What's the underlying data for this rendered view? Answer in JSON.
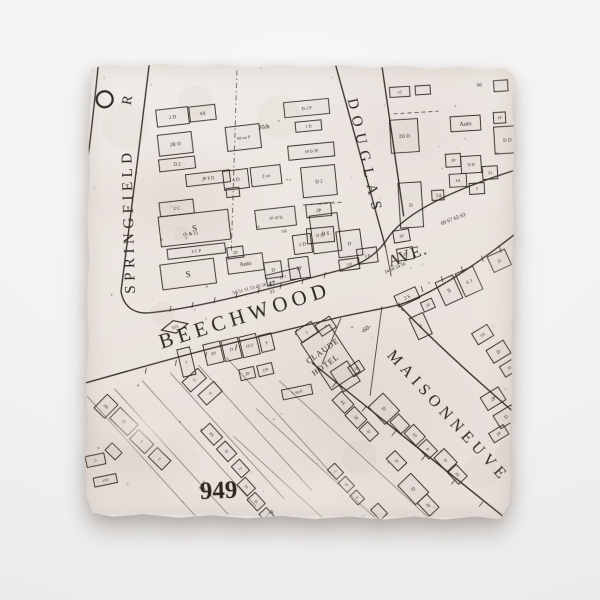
{
  "colors": {
    "ink": "#2e2722",
    "tile": "#ebe4df",
    "background": "#f3f2f1"
  },
  "map": {
    "roads": [
      {
        "id": "springfield-west",
        "d": "M 12,-4 C 6,66 -4,150 -16,234"
      },
      {
        "id": "springfield-east-beechwood-north",
        "d": "M 63,-4 C 55,70 44,162 36,230 C 39,246 50,253 66,251 C 112,246 178,228 254,207 C 281,200 294,188 304,172 C 321,149 364,126 433,104"
      },
      {
        "id": "beechwood-south",
        "d": "M -6,324 C 42,310 95,294 154,279 C 205,266 230,260 254,254 C 280,248 298,245 314,241 C 354,228 404,190 436,164"
      },
      {
        "id": "maisonneuve-north",
        "d": "M 314,241 C 336,264 374,300 433,350"
      },
      {
        "id": "maisonneuve-south",
        "d": "M 228,300 C 278,340 360,404 432,461"
      },
      {
        "id": "douglas-west",
        "d": "M 247,-4 L 300,183"
      },
      {
        "id": "douglas-east",
        "d": "M 294,-4 L 318,152"
      },
      {
        "id": "douglas-end",
        "d": "M 300,183 L 306,212",
        "w": 0.8
      },
      {
        "id": "hotel-block-east",
        "d": "M 297,243 L 286,332",
        "w": 0.8
      },
      {
        "id": "hotel-block-west",
        "d": "M 256,255 L 238,300",
        "w": 0.8
      }
    ],
    "dashed_lines": [
      {
        "d": "M 150,8 L 146,188",
        "da": "5,3,1.5,3"
      },
      {
        "d": "M 307,50 L 352,47",
        "da": "4,3"
      },
      {
        "d": "M 217,142 L 256,139",
        "da": "4,3"
      }
    ],
    "lot_lines": [
      [
        3,
        335,
        118,
        460
      ],
      [
        30,
        327,
        145,
        452
      ],
      [
        58,
        319,
        173,
        444
      ],
      [
        86,
        311,
        201,
        436
      ],
      [
        114,
        303,
        229,
        428
      ],
      [
        142,
        295,
        257,
        420
      ],
      [
        195,
        318,
        345,
        453
      ],
      [
        172,
        346,
        322,
        481
      ],
      [
        150,
        374,
        300,
        509
      ]
    ],
    "ticks": [
      [
        85,
        250,
        1.2,
        -6
      ],
      [
        107,
        246,
        1.2,
        -6
      ],
      [
        129,
        241,
        1.2,
        -6
      ],
      [
        151,
        236,
        1.2,
        -6
      ],
      [
        173,
        231,
        1.2,
        -6
      ],
      [
        195,
        226,
        1.2,
        -6
      ],
      [
        217,
        221,
        1.2,
        -6
      ],
      [
        239,
        215,
        1.2,
        -6
      ],
      [
        62,
        306,
        -1,
        6
      ],
      [
        92,
        298,
        -1,
        6
      ],
      [
        122,
        290,
        -1,
        6
      ],
      [
        152,
        282,
        -1,
        6
      ],
      [
        212,
        266,
        -1,
        6
      ],
      [
        336,
        222,
        2,
        6
      ],
      [
        356,
        212,
        2,
        6
      ],
      [
        376,
        202,
        2,
        6
      ],
      [
        396,
        191,
        2,
        6
      ],
      [
        414,
        182,
        2,
        6
      ],
      [
        252,
        319,
        -4,
        5
      ],
      [
        282,
        343,
        -4,
        5
      ],
      [
        312,
        367,
        -4,
        5
      ],
      [
        342,
        391,
        -4,
        5
      ],
      [
        372,
        415,
        -4,
        5
      ],
      [
        400,
        437,
        -4,
        5
      ]
    ],
    "buildings": [
      [
        86,
        55,
        32,
        17,
        -7,
        "2 D",
        0
      ],
      [
        116,
        51,
        26,
        15,
        -7,
        "4A",
        0
      ],
      [
        89,
        82,
        34,
        21,
        -7,
        "2R D",
        0
      ],
      [
        91,
        102,
        36,
        12,
        -7,
        "D 2",
        0
      ],
      [
        122,
        116,
        44,
        12,
        -7,
        "2P F D",
        4.5
      ],
      [
        147,
        130,
        13,
        9,
        -7,
        "",
        0
      ],
      [
        91,
        146,
        34,
        14,
        -7,
        "2 C",
        0
      ],
      [
        109,
        166,
        70,
        30,
        -7,
        "S",
        9
      ],
      [
        111,
        189,
        58,
        10,
        -7,
        "F C P",
        4.2
      ],
      [
        103,
        212,
        54,
        25,
        -8,
        "S",
        9
      ],
      [
        157,
        75,
        34,
        24,
        -7,
        "4A on P",
        4.2
      ],
      [
        150,
        117,
        25,
        19,
        -7,
        "4 D",
        0
      ],
      [
        180,
        113,
        30,
        19,
        -7,
        "2 on",
        4.5
      ],
      [
        190,
        155,
        40,
        19,
        -7,
        "1P 1P D",
        4.2
      ],
      [
        160,
        201,
        36,
        17,
        -8,
        "Auto",
        6
      ],
      [
        150,
        190,
        16,
        11,
        -8,
        "2P",
        4.2
      ],
      [
        188,
        207,
        17,
        16,
        -8,
        "D",
        0
      ],
      [
        214,
        205,
        20,
        21,
        -8,
        "2P",
        0
      ],
      [
        217,
        181,
        18,
        19,
        -8,
        "1 D",
        0
      ],
      [
        220,
        45,
        45,
        15,
        -6,
        "D 2 P",
        4.5
      ],
      [
        222,
        63,
        26,
        10,
        -6,
        "1 D",
        4.2
      ],
      [
        225,
        88,
        46,
        14,
        -6,
        "1P D 2P",
        4.2
      ],
      [
        233,
        118,
        34,
        30,
        -6,
        "D 2",
        5
      ],
      [
        233,
        147,
        25,
        13,
        -6,
        "2P",
        0
      ],
      [
        235,
        172,
        27,
        15,
        -6,
        "D 2P",
        4.2
      ],
      [
        240,
        170,
        28,
        38,
        -8,
        "D S",
        5
      ],
      [
        264,
        180,
        24,
        26,
        -8,
        "D",
        5
      ],
      [
        282,
        192,
        20,
        15,
        -8,
        "2 P",
        4.2
      ],
      [
        264,
        201,
        20,
        11,
        -8,
        "21P",
        3.8
      ],
      [
        316,
        172,
        16,
        12,
        -10,
        "2P",
        4.2
      ],
      [
        320,
        190,
        16,
        12,
        -10,
        "2P",
        4.2
      ],
      [
        313,
        28,
        20,
        10,
        -4,
        "x2",
        4.2
      ],
      [
        336,
        26,
        15,
        9,
        -4,
        "",
        0
      ],
      [
        318,
        72,
        28,
        33,
        -4,
        "2D D",
        0
      ],
      [
        379,
        59,
        30,
        15,
        -4,
        "Auto",
        6
      ],
      [
        413,
        53,
        12,
        11,
        -4,
        "1P",
        4.2
      ],
      [
        421,
        75,
        26,
        27,
        -4,
        "D D",
        0
      ],
      [
        367,
        96,
        15,
        13,
        -4,
        "1P",
        4.2
      ],
      [
        385,
        100,
        20,
        17,
        -4,
        "D D",
        4.2
      ],
      [
        404,
        108,
        15,
        13,
        -4,
        "21",
        4.2
      ],
      [
        372,
        116,
        17,
        13,
        -4,
        "4A",
        4.2
      ],
      [
        391,
        124,
        15,
        11,
        -4,
        "2",
        4.2
      ],
      [
        325,
        141,
        23,
        45,
        -4,
        "D",
        0
      ],
      [
        352,
        131,
        12,
        10,
        -4,
        "",
        0
      ],
      [
        414,
        21,
        14,
        11,
        -4,
        "",
        0
      ],
      [
        322,
        233,
        23,
        12,
        -25,
        "2 S",
        0
      ],
      [
        364,
        226,
        19,
        25,
        -25,
        "S",
        6
      ],
      [
        384,
        217,
        19,
        25,
        -25,
        "S 3",
        0
      ],
      [
        414,
        196,
        19,
        17,
        -25,
        "D",
        0
      ],
      [
        343,
        241,
        12,
        10,
        -25,
        "1P",
        4.2
      ],
      [
        336,
        262,
        15,
        23,
        -25,
        "P",
        0
      ],
      [
        398,
        270,
        18,
        13,
        -32,
        "5A",
        4.2
      ],
      [
        414,
        287,
        20,
        15,
        -32,
        "D",
        0
      ],
      [
        425,
        303,
        16,
        12,
        -32,
        "D",
        4.2
      ],
      [
        409,
        334,
        21,
        15,
        -32,
        "2P",
        0
      ],
      [
        422,
        352,
        21,
        15,
        -32,
        "D",
        0
      ],
      [
        415,
        369,
        17,
        11,
        -32,
        "2P",
        4.2
      ],
      [
        246,
        294,
        34,
        56,
        -34,
        "",
        0
      ],
      [
        261,
        313,
        20,
        24,
        -34,
        "",
        0
      ],
      [
        222,
        269,
        19,
        13,
        -34,
        "2",
        4.2
      ],
      [
        241,
        263,
        17,
        13,
        -34,
        "4",
        4.2
      ],
      [
        272,
        305,
        13,
        11,
        -34,
        "1D",
        4
      ],
      [
        213,
        329,
        30,
        10,
        -12,
        "1 on P",
        4
      ],
      [
        198,
        214,
        34,
        11,
        -14,
        "2P 1",
        4.2
      ],
      [
        129,
        291,
        17,
        21,
        -14,
        "2D",
        4.2
      ],
      [
        147,
        287,
        17,
        21,
        -14,
        "D",
        4.5
      ],
      [
        165,
        283,
        17,
        21,
        -14,
        "D13",
        4
      ],
      [
        182,
        280,
        13,
        17,
        -14,
        "P",
        4.2
      ],
      [
        163,
        311,
        15,
        11,
        -14,
        "2P",
        4
      ],
      [
        181,
        307,
        15,
        11,
        -14,
        "21P",
        3.8
      ],
      [
        110,
        318,
        21,
        13,
        -42,
        "5",
        4.2
      ],
      [
        126,
        331,
        21,
        13,
        -42,
        "4",
        4.2
      ],
      [
        102,
        300,
        13,
        28,
        -14,
        "1",
        4.2
      ],
      [
        40,
        360,
        25,
        15,
        44,
        "D",
        0
      ],
      [
        58,
        380,
        21,
        13,
        44,
        "P",
        4.2
      ],
      [
        76,
        397,
        19,
        13,
        44,
        "2",
        4.2
      ],
      [
        30,
        390,
        14,
        10,
        44,
        "",
        0
      ],
      [
        22,
        345,
        15,
        19,
        44,
        "2D",
        4
      ],
      [
        12,
        399,
        19,
        11,
        -12,
        "5",
        4.2
      ],
      [
        22,
        419,
        23,
        9,
        -12,
        "1VF",
        3.8
      ],
      [
        128,
        372,
        19,
        12,
        47,
        "4A",
        4.2
      ],
      [
        143,
        389,
        17,
        12,
        47,
        "D",
        4.2
      ],
      [
        157,
        406,
        15,
        11,
        47,
        "2",
        4.2
      ],
      [
        163,
        424,
        15,
        11,
        47,
        "2S",
        3.8
      ],
      [
        173,
        439,
        15,
        11,
        47,
        "D",
        4.2
      ],
      [
        184,
        453,
        13,
        10,
        47,
        "1",
        4.2
      ],
      [
        259,
        339,
        18,
        13,
        46,
        "4A",
        4.2
      ],
      [
        272,
        354,
        18,
        13,
        46,
        "1P",
        4.2
      ],
      [
        285,
        368,
        16,
        12,
        46,
        "D",
        4.2
      ],
      [
        300,
        345,
        24,
        20,
        46,
        "D",
        5
      ],
      [
        316,
        360,
        16,
        12,
        46,
        "",
        0
      ],
      [
        331,
        371,
        17,
        13,
        46,
        "1D",
        4
      ],
      [
        344,
        385,
        16,
        12,
        46,
        "P",
        4.2
      ],
      [
        313,
        397,
        17,
        12,
        46,
        "2F",
        4
      ],
      [
        330,
        425,
        26,
        18,
        46,
        "D",
        5
      ],
      [
        345,
        441,
        18,
        13,
        46,
        "2P",
        4.2
      ],
      [
        362,
        396,
        19,
        14,
        46,
        "D",
        4.2
      ],
      [
        374,
        410,
        16,
        12,
        46,
        "4X",
        3.8
      ],
      [
        252,
        408,
        13,
        10,
        46,
        "2",
        4
      ],
      [
        263,
        421,
        13,
        10,
        46,
        "1P",
        3.8
      ],
      [
        274,
        434,
        12,
        9,
        46,
        "8",
        4
      ],
      [
        296,
        448,
        14,
        10,
        46,
        "",
        0
      ]
    ],
    "symbols": {
      "circle": {
        "x": 18,
        "y": 38,
        "r": 8
      },
      "diamond": {
        "x": 90,
        "y": 265,
        "w": 27,
        "h": 13,
        "r": -14,
        "t": "333"
      }
    },
    "labels": [
      {
        "id": "springfield",
        "t": "SPRINGFIELD",
        "x": 50,
        "y": 232,
        "r": -92,
        "fs": 15,
        "ls": 4.5
      },
      {
        "id": "springfield-road-r",
        "t": "R",
        "x": 44,
        "y": 44,
        "r": -80,
        "fs": 14
      },
      {
        "id": "douglas",
        "t": "DOUGLAS",
        "x": 261,
        "y": 36,
        "r": 77,
        "fs": 15,
        "ls": 7
      },
      {
        "id": "beechwood",
        "t": "BEECHWOOD",
        "x": 77,
        "y": 287,
        "r": -18,
        "fs": 21,
        "ls": 5
      },
      {
        "id": "ave",
        "t": "AVE.",
        "x": 305,
        "y": 203,
        "r": -20,
        "fs": 16,
        "ls": 1.5
      },
      {
        "id": "maisonneuve",
        "t": "MAISONNEUVE",
        "x": 302,
        "y": 292,
        "r": 47,
        "fs": 16,
        "ls": 5
      },
      {
        "id": "block-number-949",
        "t": "949",
        "x": 117,
        "y": 437,
        "r": -3,
        "fs": 25,
        "b": 1
      },
      {
        "id": "claude",
        "t": "CLAUDE",
        "x": 224,
        "y": 301,
        "r": -36,
        "fs": 8,
        "ls": 1
      },
      {
        "id": "hotel",
        "t": "HOTEL",
        "x": 230,
        "y": 313,
        "r": -36,
        "fs": 8,
        "ls": 1
      },
      {
        "id": "dim-60",
        "t": "-60-",
        "x": 278,
        "y": 270,
        "r": -36,
        "fs": 6.5
      },
      {
        "id": "lot-20a",
        "t": "20A",
        "x": 172,
        "y": 67,
        "r": -8,
        "fs": 6.5
      },
      {
        "id": "lot-47",
        "t": "47",
        "x": 184,
        "y": 224,
        "r": -15,
        "fs": 7,
        "b": 1
      },
      {
        "id": "lot-33",
        "t": "33",
        "x": 185,
        "y": 231,
        "r": -15,
        "fs": 5
      },
      {
        "id": "lot-row-west",
        "t": "50 51 51 53 45 56",
        "x": 148,
        "y": 232,
        "r": -15,
        "fs": 4.8
      },
      {
        "id": "lot-row-mid",
        "t": "34 58 54 56",
        "x": 300,
        "y": 210,
        "r": -24,
        "fs": 4.8
      },
      {
        "id": "lot-row-east",
        "t": "69 67 65 63",
        "x": 356,
        "y": 161,
        "r": -22,
        "fs": 5.5
      },
      {
        "id": "lot-60",
        "t": "60",
        "x": 390,
        "y": 22,
        "r": 0,
        "fs": 5
      },
      {
        "id": "lot-p",
        "t": "P",
        "x": 185,
        "y": 450,
        "r": 45,
        "fs": 7
      },
      {
        "id": "note-bc",
        "t": "(b & c)",
        "x": 98,
        "y": 174,
        "r": -7,
        "fs": 5
      },
      {
        "id": "stray-5a-east",
        "t": "5A",
        "x": 350,
        "y": 133,
        "r": 0,
        "fs": 5
      },
      {
        "id": "stray-5a-west",
        "t": "5A",
        "x": 196,
        "y": 170,
        "r": -8,
        "fs": 4.5
      }
    ]
  }
}
